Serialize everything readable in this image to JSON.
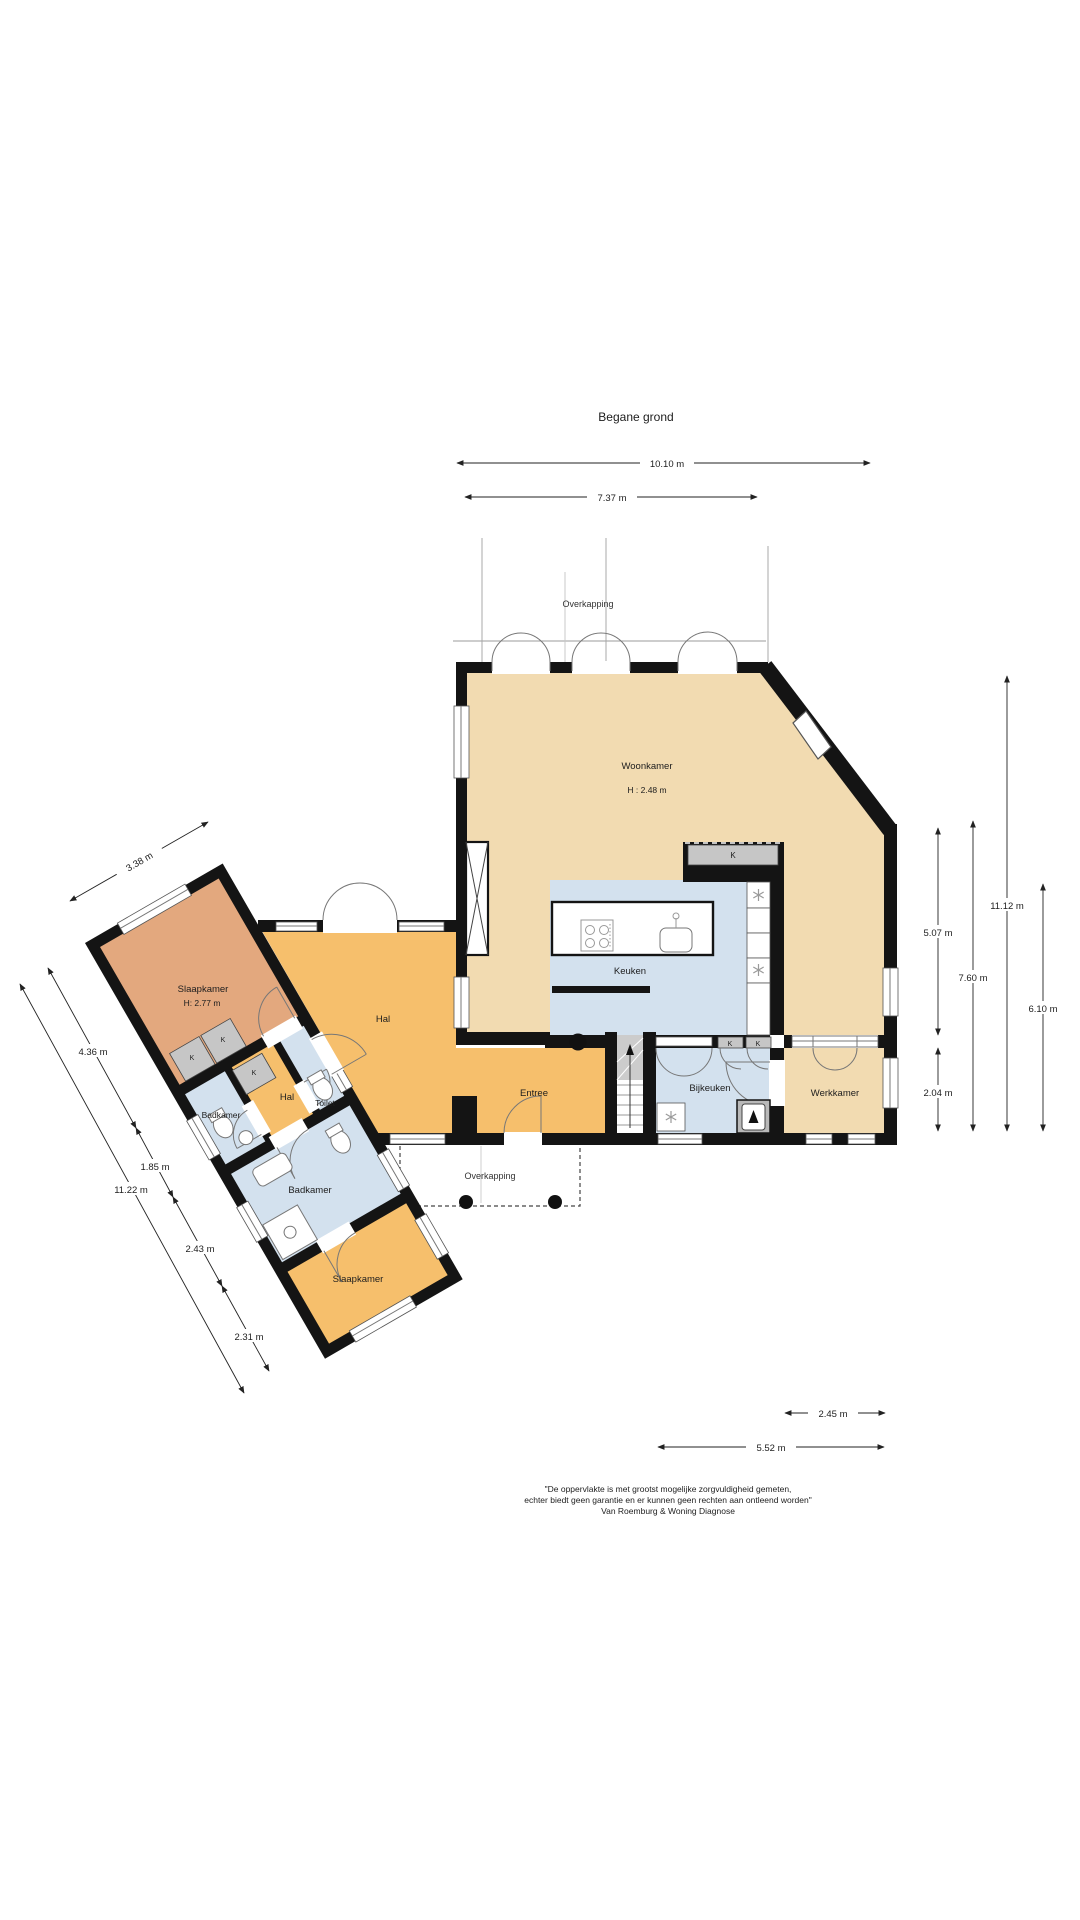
{
  "title": "Begane grond",
  "canopy": {
    "top": "Overkapping",
    "bottom": "Overkapping"
  },
  "rooms": {
    "woonkamer": {
      "name": "Woonkamer",
      "height": "H : 2.48 m"
    },
    "keuken": {
      "name": "Keuken"
    },
    "bijkeuken": {
      "name": "Bijkeuken"
    },
    "werkkamer": {
      "name": "Werkkamer"
    },
    "entree": {
      "name": "Entree"
    },
    "hal": {
      "name": "Hal"
    },
    "hal_klein": {
      "name": "Hal"
    },
    "toilet": {
      "name": "Toilet"
    },
    "badkamer_klein": {
      "name": "Badkamer"
    },
    "badkamer_groot": {
      "name": "Badkamer"
    },
    "slaapkamer_boven": {
      "name": "Slaapkamer",
      "height": "H: 2.77 m"
    },
    "slaapkamer_onder": {
      "name": "Slaapkamer"
    }
  },
  "closet_label": "K",
  "dimensions": {
    "top_total": "10.10 m",
    "top_inner": "7.37 m",
    "right_1": "5.07 m",
    "right_2": "7.60 m",
    "right_3": "11.12 m",
    "right_4": "6.10 m",
    "right_5": "2.04 m",
    "bottom_1": "2.45 m",
    "bottom_2": "5.52 m",
    "left_width": "3.38 m",
    "left_1": "4.36 m",
    "left_2": "1.85 m",
    "left_3": "2.43 m",
    "left_4": "2.31 m",
    "left_total": "11.22 m"
  },
  "disclaimer": {
    "line1": "\"De oppervlakte is met grootst mogelijke zorgvuldigheid gemeten,",
    "line2": "echter biedt geen garantie en er kunnen geen rechten aan ontleend worden\"",
    "line3": "Van Roemburg & Woning Diagnose"
  },
  "colors": {
    "living_tan": "#f2dbb1",
    "hall_orange": "#f6bf6c",
    "bedroom_salmon": "#e3a87e",
    "wet_blue": "#d3e1ee",
    "wall_black": "#141414",
    "closet_grey": "#c6c6c6"
  }
}
